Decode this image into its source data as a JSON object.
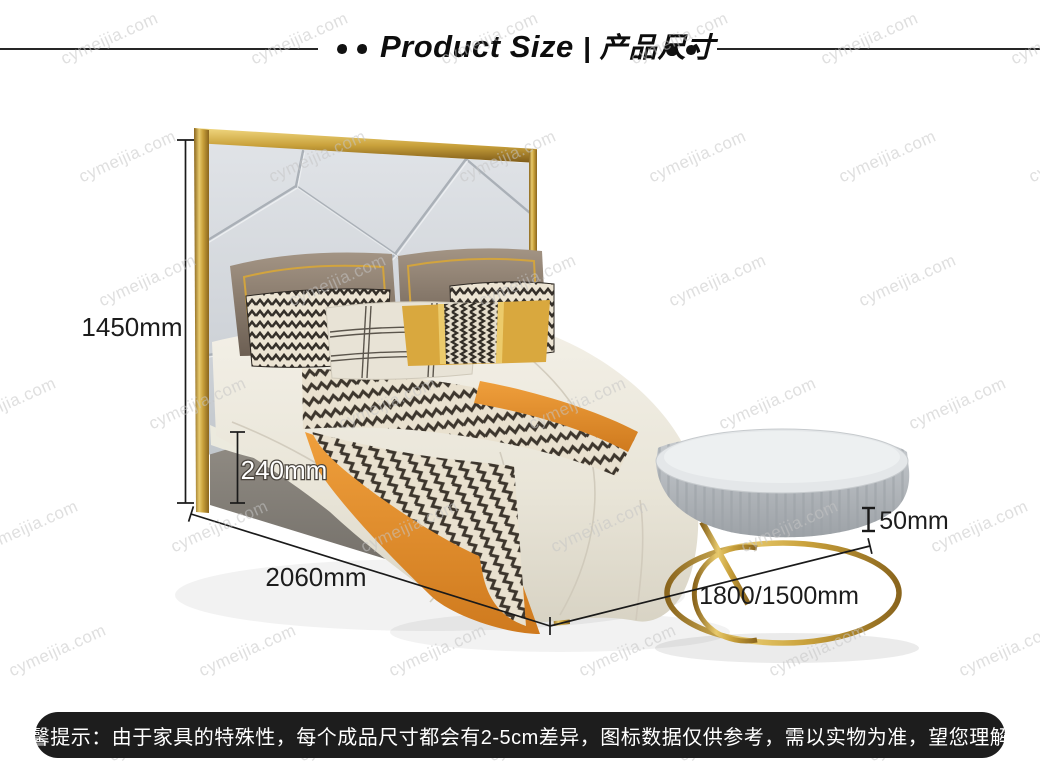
{
  "header": {
    "title_en": "Product Size",
    "separator": "|",
    "title_zh": "产品尺寸"
  },
  "dimensions": {
    "overall_height": "1450mm",
    "base_height": "240mm",
    "length": "2060mm",
    "width_options": "1800/1500mm",
    "stool_detail": "50mm"
  },
  "watermark": {
    "text": "cymeijia.com",
    "positions": [
      [
        62,
        60
      ],
      [
        252,
        60
      ],
      [
        442,
        60
      ],
      [
        632,
        60
      ],
      [
        822,
        60
      ],
      [
        1012,
        60
      ],
      [
        80,
        178
      ],
      [
        270,
        178
      ],
      [
        460,
        178
      ],
      [
        650,
        178
      ],
      [
        840,
        178
      ],
      [
        1030,
        178
      ],
      [
        100,
        302
      ],
      [
        290,
        302
      ],
      [
        480,
        302
      ],
      [
        670,
        302
      ],
      [
        860,
        302
      ],
      [
        1050,
        302
      ],
      [
        -40,
        425
      ],
      [
        150,
        425
      ],
      [
        340,
        425
      ],
      [
        530,
        425
      ],
      [
        720,
        425
      ],
      [
        910,
        425
      ],
      [
        -18,
        548
      ],
      [
        172,
        548
      ],
      [
        362,
        548
      ],
      [
        552,
        548
      ],
      [
        742,
        548
      ],
      [
        932,
        548
      ],
      [
        10,
        672
      ],
      [
        200,
        672
      ],
      [
        390,
        672
      ],
      [
        580,
        672
      ],
      [
        770,
        672
      ],
      [
        960,
        672
      ],
      [
        110,
        757
      ],
      [
        300,
        757
      ],
      [
        490,
        757
      ],
      [
        680,
        757
      ],
      [
        870,
        757
      ]
    ]
  },
  "footer": {
    "notice": "温馨提示：由于家具的特殊性，每个成品尺寸都会有2-5cm差异，图标数据仅供参考，需以实物为准，望您理解！"
  },
  "colors": {
    "gold": "#c9a23c",
    "orange": "#e0862a",
    "dimension_line": "#1a1a1a",
    "notice_bar": "#1d1d1d"
  }
}
